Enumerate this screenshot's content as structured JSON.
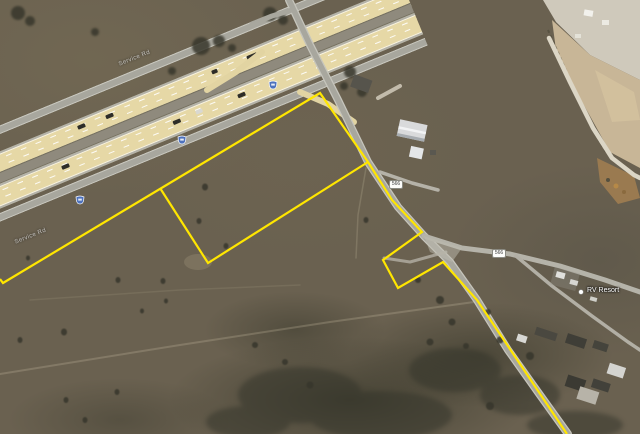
{
  "map": {
    "poi_label": "RV Resort",
    "service_road_label": "Service Rd",
    "route_badges": [
      {
        "text": "566"
      },
      {
        "text": "566"
      }
    ],
    "interstate_shields": {
      "count": 3,
      "color": "#4e72bd"
    },
    "colors": {
      "boundary_yellow": "#ffe600",
      "highway_lane_tan": "#e6d8a6",
      "road_gray": "#a8a79e",
      "terrain_brown": "#6a6150",
      "construction_tan": "#c8b697"
    },
    "parcel_boundary": {
      "outer_points": [
        [
          0,
          279
        ],
        [
          3,
          283
        ],
        [
          320,
          93
        ],
        [
          368,
          162
        ],
        [
          392,
          200
        ],
        [
          422,
          232
        ],
        [
          383,
          260
        ],
        [
          398,
          288
        ],
        [
          443,
          262
        ],
        [
          477,
          300
        ],
        [
          567,
          434
        ]
      ],
      "inner_divider_points": [
        [
          160,
          188
        ],
        [
          208,
          263
        ],
        [
          368,
          162
        ]
      ]
    }
  }
}
